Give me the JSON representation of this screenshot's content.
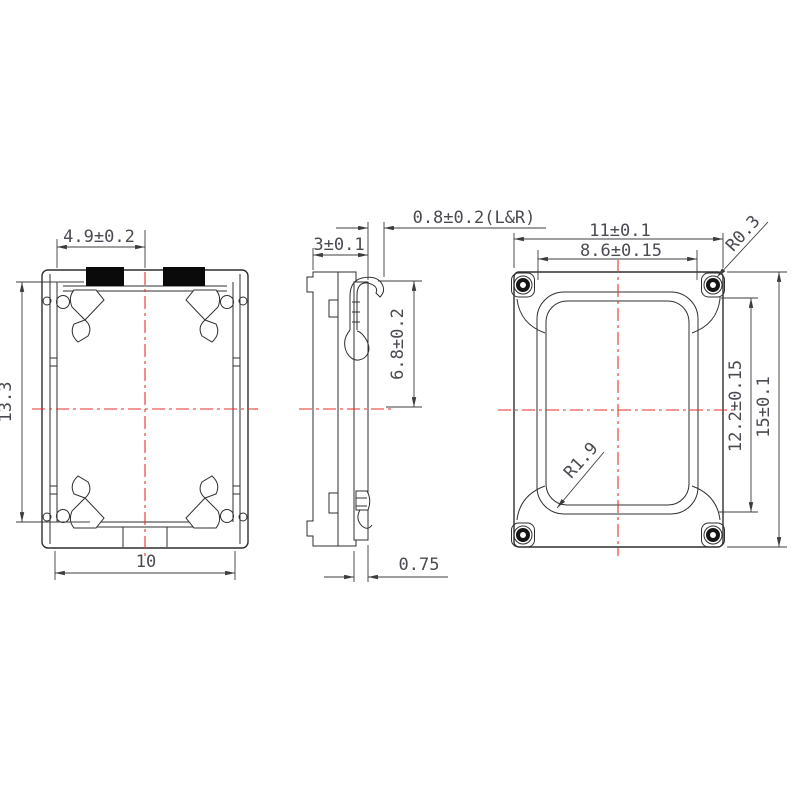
{
  "drawing": {
    "type": "mechanical-3-view",
    "dims": {
      "front": {
        "pad_offset": "4.9±0.2",
        "height": "13.3",
        "width": "10"
      },
      "side": {
        "thickness": "3±0.1",
        "terminal_protrusion": "0.8±0.2(L&R)",
        "terminal_height": "6.8±0.2",
        "bottom_width": "0.75"
      },
      "back": {
        "width": "11±0.1",
        "opening_width": "8.6±0.15",
        "corner_radius": "R0.3",
        "opening_radius": "R1.9",
        "hole_span": "12.2±0.15",
        "height": "15±0.1"
      }
    },
    "colors": {
      "line": "#2f2f2f",
      "centerline": "#e8312b",
      "pad": "#0a0a0a",
      "text": "#4a4a52"
    }
  }
}
